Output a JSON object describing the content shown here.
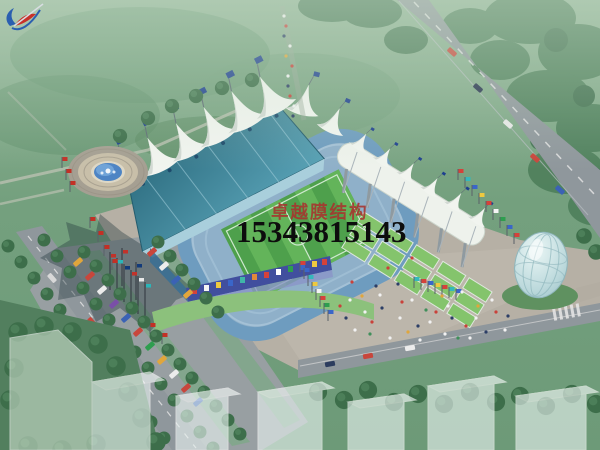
{
  "watermark": {
    "logo_icon": "sail-swoosh-logo",
    "company_name": "卓越膜结构",
    "phone_number": "15343815143",
    "company_color": "#a8332e",
    "phone_color": "#0d0d0d"
  },
  "scene": {
    "type": "architectural-aerial-rendering",
    "elements": [
      "green-parkland",
      "forest",
      "main-road",
      "tree-lined-avenue",
      "parking-lot",
      "stadium-bowl",
      "membrane-roof-peaks",
      "grandstand-roof",
      "football-pitch",
      "steel-masts",
      "terraced-steps",
      "banner-facade",
      "fountain-plaza",
      "flag-poles",
      "pedestrian-plaza",
      "crowd",
      "glass-egg-dome",
      "crosswalk",
      "ghost-buildings"
    ],
    "colors": {
      "parkland_green": "#75a17f",
      "forest_green": "#4e7f5b",
      "road_gray": "#8f979c",
      "plaza_gray": "#b6b0a5",
      "pitch_green_dark": "#4ea04c",
      "pitch_green_light": "#63b45a",
      "roof_teal": "#3d7f96",
      "membrane_white": "#f1f4ef",
      "stand_blue": "#7fa9c9",
      "fountain_water_blue": "#4d84c4",
      "terrace_green": "#84c46c",
      "dome_glass": "#bcd9dc"
    }
  }
}
